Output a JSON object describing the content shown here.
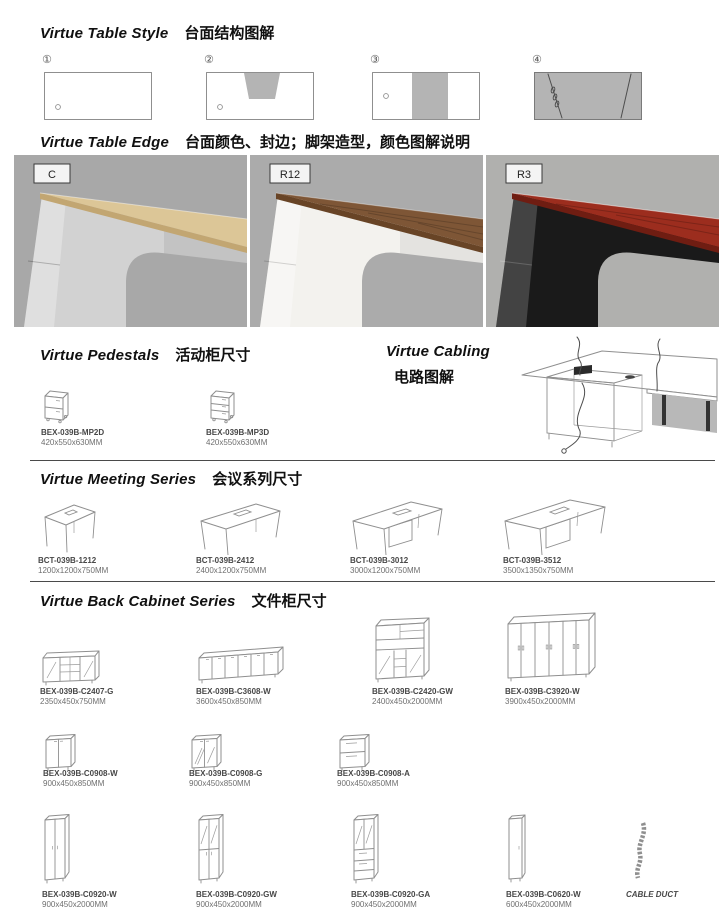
{
  "sections": {
    "table_style": {
      "title_en": "Virtue Table Style",
      "title_zh": "台面结构图解",
      "items": [
        {
          "num": "①"
        },
        {
          "num": "②"
        },
        {
          "num": "③"
        },
        {
          "num": "④"
        }
      ]
    },
    "table_edge": {
      "title_en": "Virtue Table Edge",
      "title_zh": "台面颜色、封边；脚架造型，颜色图解说明",
      "photos": [
        {
          "label": "C",
          "bg": "#a8a8a8",
          "top": "#dcc697",
          "edge": "#c2a672",
          "leg": "#d2d2d2"
        },
        {
          "label": "R12",
          "bg": "#ababab",
          "top": "#7e5636",
          "edge": "#684426",
          "leg": "#f3f2ee"
        },
        {
          "label": "R3",
          "bg": "#b0b0ae",
          "top": "#9c2d1e",
          "edge": "#6f1d12",
          "leg": "#1a1a1a"
        }
      ]
    },
    "pedestals": {
      "title_en": "Virtue Pedestals",
      "title_zh": "活动柜尺寸",
      "items": [
        {
          "code": "BEX-039B-MP2D",
          "size": "420x550x630MM"
        },
        {
          "code": "BEX-039B-MP3D",
          "size": "420x550x630MM"
        }
      ]
    },
    "cabling": {
      "title_en": "Virtue Cabling",
      "title_zh": "电路图解"
    },
    "meeting": {
      "title_en": "Virtue Meeting Series",
      "title_zh": "会议系列尺寸",
      "items": [
        {
          "code": "BCT-039B-1212",
          "size": "1200x1200x750MM"
        },
        {
          "code": "BCT-039B-2412",
          "size": "2400x1200x750MM"
        },
        {
          "code": "BCT-039B-3012",
          "size": "3000x1200x750MM"
        },
        {
          "code": "BCT-039B-3512",
          "size": "3500x1350x750MM"
        }
      ]
    },
    "back_cabinet": {
      "title_en": "Virtue Back Cabinet Series",
      "title_zh": "文件柜尺寸",
      "row1": [
        {
          "code": "BEX-039B-C2407-G",
          "size": "2350x450x750MM"
        },
        {
          "code": "BEX-039B-C3608-W",
          "size": "3600x450x850MM"
        },
        {
          "code": "BEX-039B-C2420-GW",
          "size": "2400x450x2000MM"
        },
        {
          "code": "BEX-039B-C3920-W",
          "size": "3900x450x2000MM"
        }
      ],
      "row2": [
        {
          "code": "BEX-039B-C0908-W",
          "size": "900x450x850MM"
        },
        {
          "code": "BEX-039B-C0908-G",
          "size": "900x450x850MM"
        },
        {
          "code": "BEX-039B-C0908-A",
          "size": "900x450x850MM"
        }
      ],
      "row3": [
        {
          "code": "BEX-039B-C0920-W",
          "size": "900x450x2000MM"
        },
        {
          "code": "BEX-039B-C0920-GW",
          "size": "900x450x2000MM"
        },
        {
          "code": "BEX-039B-C0920-GA",
          "size": "900x450x2000MM"
        },
        {
          "code": "BEX-039B-C0620-W",
          "size": "600x450x2000MM"
        }
      ],
      "cable_duct_label": "CABLE DUCT"
    }
  }
}
